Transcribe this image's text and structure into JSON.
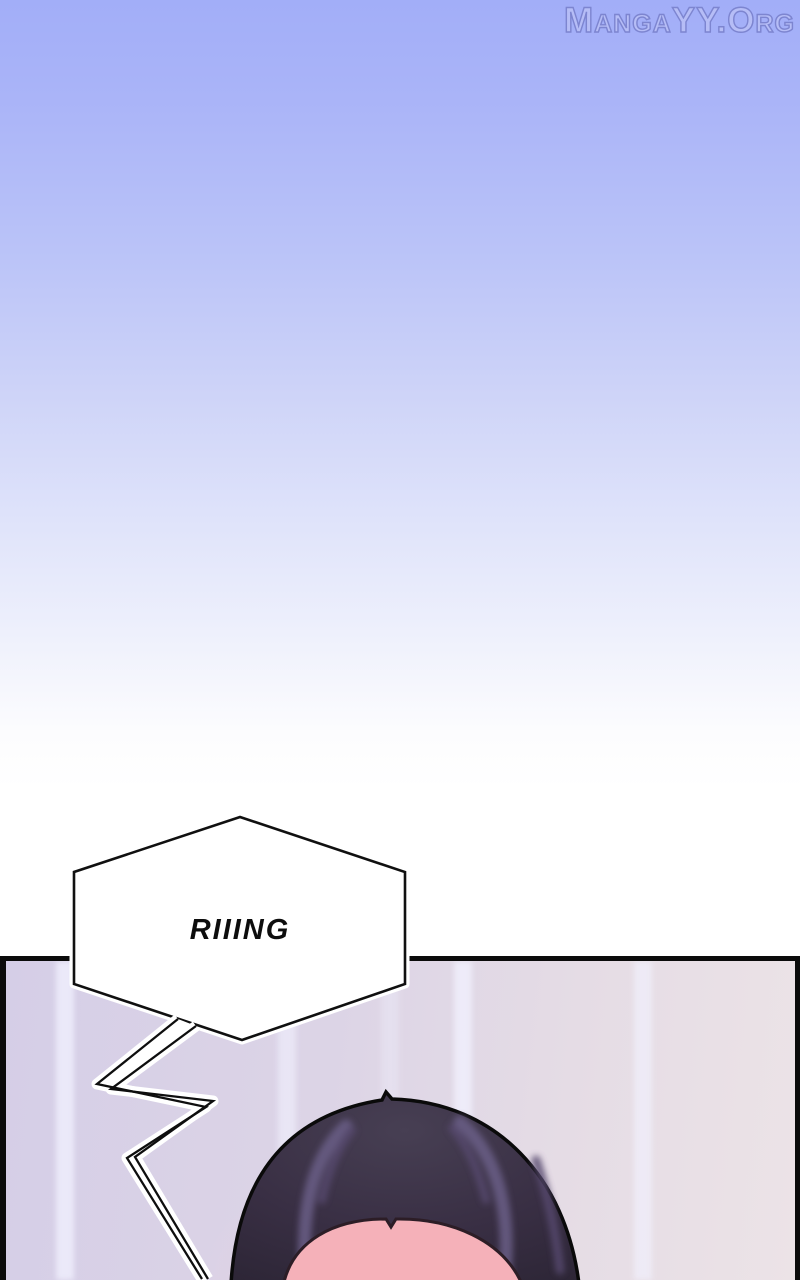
{
  "site": {
    "watermark": "MangaYY.Org"
  },
  "panel": {
    "sfx": "RIIING"
  },
  "colors": {
    "sky_top": "#a2aef8",
    "sky_bottom": "#ffffff",
    "panel_bg_left": "#d5cee7",
    "panel_bg_right": "#ece3e7",
    "panel_border": "#0b0b0b",
    "bubble_fill": "#ffffff",
    "bubble_outline": "#101010",
    "hair_dark": "#352e40",
    "hair_highlight": "#6b5f87",
    "skin": "#f5b1b9",
    "watermark_fill": "#b6bdf6",
    "watermark_outline": "#7d85d0"
  }
}
